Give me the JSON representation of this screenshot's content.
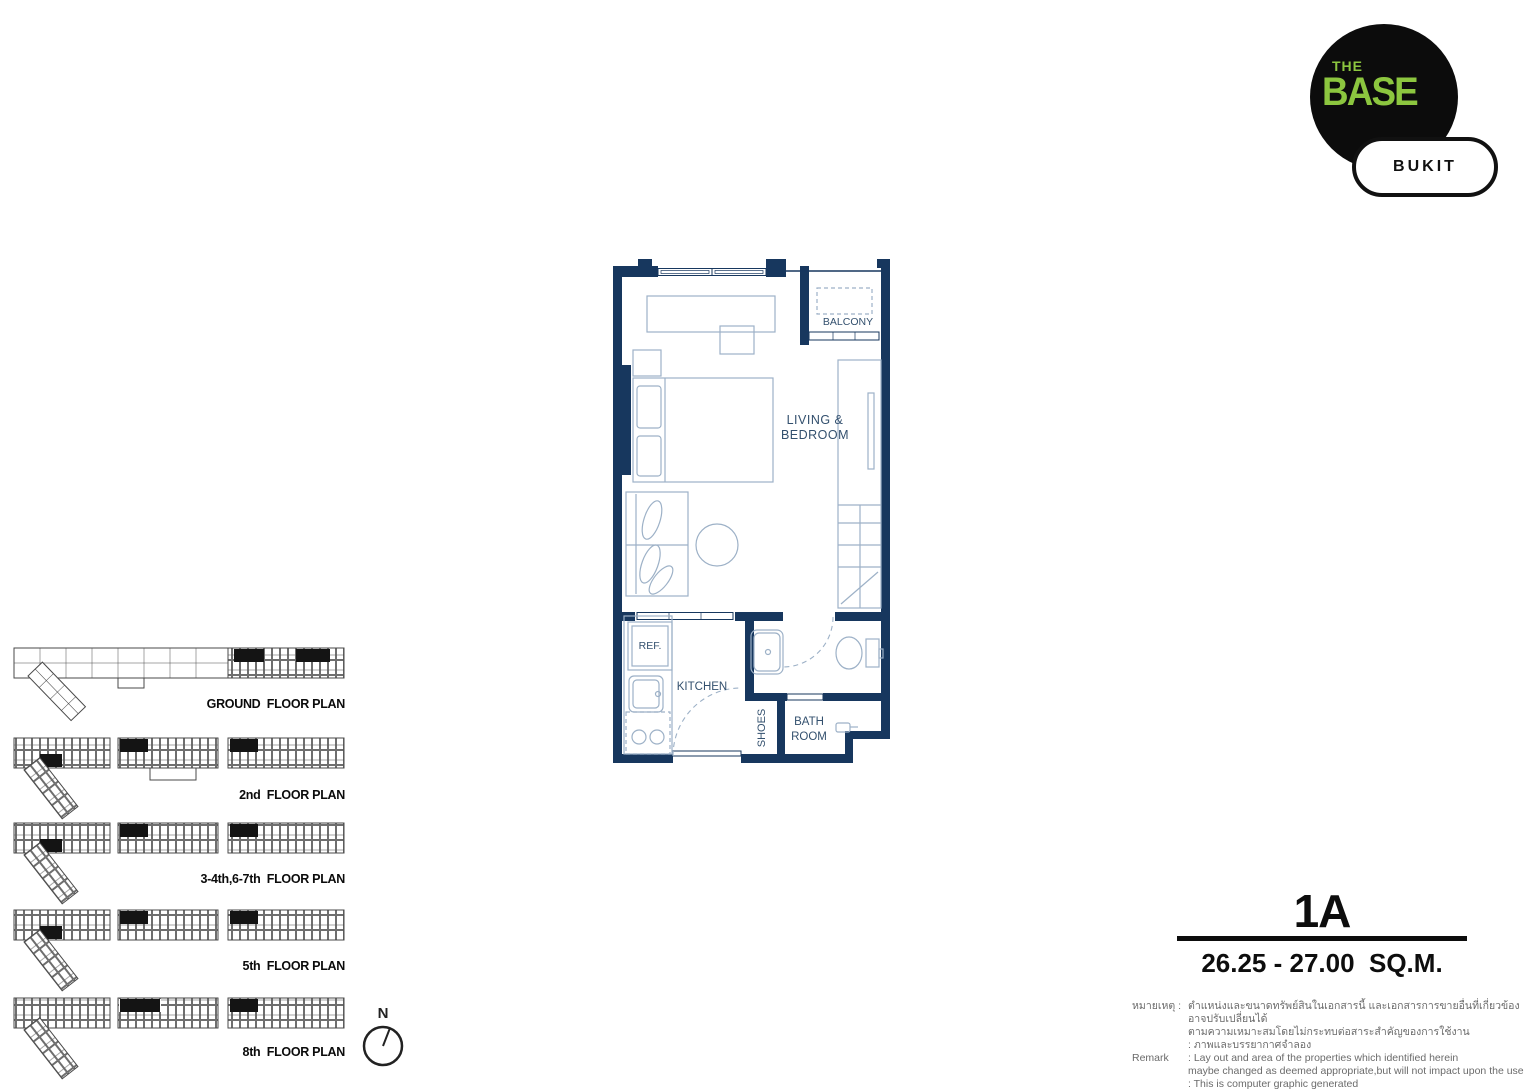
{
  "logo": {
    "the": "THE",
    "base": "BASE",
    "badge": "BUKIT"
  },
  "colors": {
    "wall_navy": "#17375e",
    "furniture_blue": "#9db1c7",
    "logo_green": "#8cc63f",
    "text_navy": "#33506e"
  },
  "floor_plans": {
    "items": [
      {
        "label": "GROUND  FLOOR PLAN"
      },
      {
        "label": "2nd  FLOOR PLAN"
      },
      {
        "label": "3-4th,6-7th  FLOOR PLAN"
      },
      {
        "label": "5th  FLOOR PLAN"
      },
      {
        "label": "8th  FLOOR PLAN"
      }
    ]
  },
  "compass": {
    "north_label": "N"
  },
  "plan": {
    "rooms": {
      "living_line1": "LIVING &",
      "living_line2": "BEDROOM",
      "balcony": "BALCONY",
      "kitchen": "KITCHEN",
      "ref": "REF.",
      "shoes": "SHOES",
      "bath_line1": "BATH",
      "bath_line2": "ROOM"
    }
  },
  "unit": {
    "code": "1A",
    "area_range": "26.25 - 27.00  SQ.M."
  },
  "remark": {
    "thai_label": "หมายเหตุ :",
    "thai_lines": [
      "ตำแหน่งและขนาดทรัพย์สินในเอกสารนี้ และเอกสารการขายอื่นที่เกี่ยวข้อง อาจปรับเปลี่ยนได้",
      "ตามความเหมาะสมโดยไม่กระทบต่อสาระสำคัญของการใช้งาน",
      ": ภาพและบรรยากาศจำลอง"
    ],
    "en_label": "Remark",
    "en_lines": [
      ": Lay out and area of the properties which identified herein",
      "maybe changed as deemed appropriate,but will not impact upon the use",
      ": This is computer graphic generated"
    ]
  }
}
